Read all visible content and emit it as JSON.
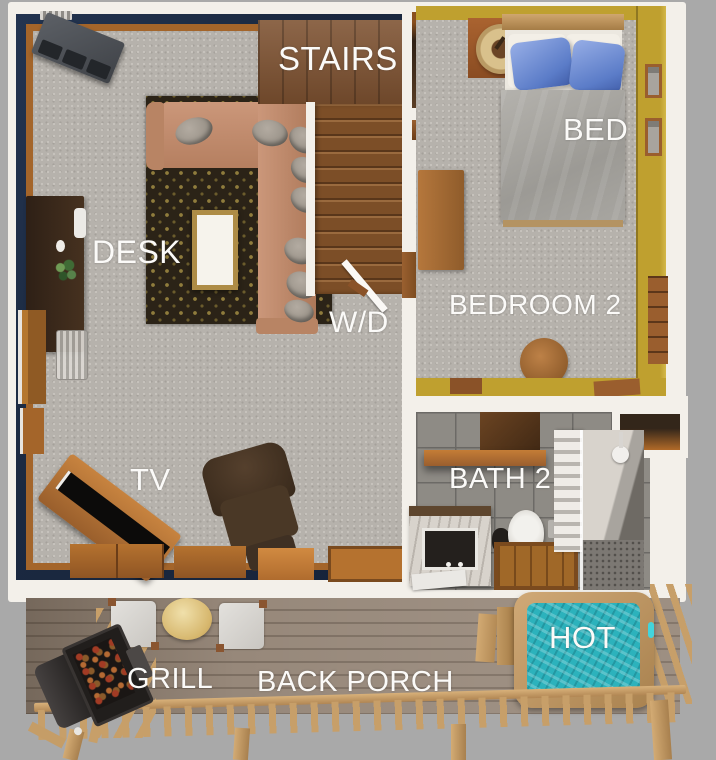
{
  "scene": {
    "description": "3D rendered cabin floor plan, top-down view, with back porch"
  },
  "labels": {
    "stairs": "STAIRS",
    "bed": "BED",
    "desk": "DESK",
    "washer_dryer": "W/D",
    "bedroom_2": "BEDROOM 2",
    "bath_2": "BATH 2",
    "tv": "TV",
    "grill": "GRILL",
    "back_porch": "BACK PORCH",
    "hot_tub": "HOT"
  },
  "colors": {
    "bg": "#a9a9a9",
    "white": "#f3f0ea",
    "navy": "#1b2940",
    "trim": "#a4652a",
    "carpet": "#b6b2ac",
    "carpetdot": "#c8c4be",
    "rug": "#2b2317",
    "rugdot": "#8f7c3c",
    "stairwood": "#7d5130",
    "yellow": "#bfa02f",
    "duvet": "#9c9a95",
    "bluepillow": "#5b7cc8",
    "tile": "#8e8b85",
    "grout": "#6c6a66",
    "showerwall": "#6e6a64",
    "deck": "#97887a",
    "deckline": "#7d6f62",
    "rail": "#c79f69",
    "water": "#2cb2bc"
  }
}
